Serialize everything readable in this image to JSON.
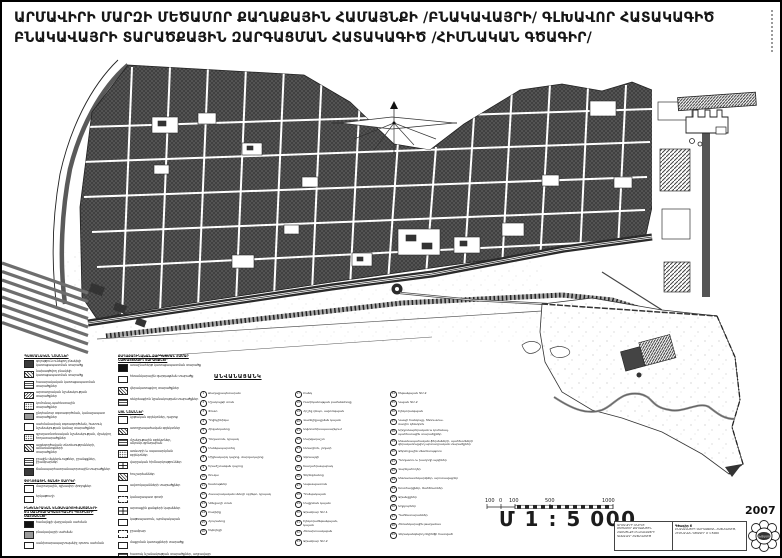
{
  "title": {
    "line1": "ԱՐՄԱՎԻՐԻ ՄԱՐԶԻ ՄԵԾԱՄՈՐ ՔԱՂԱՔԱՅԻՆ ՀԱՄԱՅՆՔԻ /ԲՆԱԿԱՎԱՅՐԻ/ ԳԼԽԱՎՈՐ ՀԱՏԱԿԱԳԻԾ",
    "line2": "ԲՆԱԿԱՎԱՅՐԻ ՏԱՐԱԾՔԱՅԻՆ ԶԱՐԳԱՑՄԱՆ ՀԱՏԱԿԱԳԻԾ /ՀԻՄՆԱԿԱՆ ԳԾԱԳԻՐ/"
  },
  "legend": {
    "columns": [
      [
        {
          "h": "ՊԱՅՄԱՆԱԿԱՆ ՆՇԱՆՆԵՐ"
        },
        {
          "s": "solid",
          "t": "գոյություն ունեցող բնակելի\nկառուցապատման տարածք"
        },
        {
          "s": "hatch",
          "t": "նախագծվող բնակելի\nկառուցապատման տարածք"
        },
        {
          "s": "grid",
          "t": "հասարակական կառուցապատման\nտարածքներ"
        },
        {
          "s": "diag",
          "t": "արտադրական նշանակության\nտարածքներ"
        },
        {
          "s": "dots",
          "t": "կոմունալ-պահեստային\nտարածքներ"
        },
        {
          "s": "gray",
          "t": "ընդհանուր օգտագործման, կանաչապատ\nտարածքներ"
        },
        {
          "s": "outline",
          "t": "սահմանափակ օգտագործման, հատուկ\nնշանակության կանաչ տարածքներ"
        },
        {
          "s": "dots",
          "t": "գյուղատնտեսական նշանակության, մշակվող\nհողատարածքներ"
        },
        {
          "s": "hatch",
          "t": "այգեգործական տնտեսությունների, ամառանոցների\nտարածքներ"
        },
        {
          "s": "grid",
          "t": "ջրային մակերևույթներ, ջրանցքներ,\nջրամբարներ"
        },
        {
          "s": "solid",
          "t": "ճանապարհատրանսպորտային տարածքներ"
        },
        {
          "h": "ՓՈՂՈՑԱՅԻՆ ՑԱՆՑԻ ՏԱՐՐԵՐ"
        },
        {
          "s": "outline",
          "t": "մայրուղային, գլխավոր փողոցներ"
        },
        {
          "s": "outline",
          "t": "երկաթուղի"
        },
        {
          "h": "ԻՆԺԵՆԵՐԱԿԱՆ ԵՆԹԱԿԱՌՈՒՑՎԱԾՔՆԵՐԻ\nԵՎ ՍԱՆԻՏԱՐԱՊԱՇՏՊԱՆԻՉ ԳՈՏԻՆԵՐԻ\nՍԱՀՄԱՆՆԵՐ"
        },
        {
          "s": "dark",
          "t": "համայնքի վարչական սահման"
        },
        {
          "s": "gray",
          "t": "բնակավայրի սահման"
        },
        {
          "s": "outline",
          "t": "սանիտարապաշտպանիչ գոտու սահման"
        }
      ],
      [
        {
          "h": "ՔԱՂԱՔԱՇԻՆԱԿԱՆ ԶԱՐԳԱՑՄԱՆ ՀԱՄԱՐ\nՆԱԽԱՏԵՍՎՈՂ ՏԱՐԱԾՔՆԵՐ"
        },
        {
          "s": "dark",
          "t": "առաջնահերթ կառուցապատման տարածք"
        },
        {
          "s": "outline",
          "t": "հեռանկարային զարգացման տարածք"
        },
        {
          "s": "hatch",
          "t": "վերակառուցվող տարածքներ"
        },
        {
          "s": "grid",
          "t": "ռեկրեացիոն նշանակության տարածքներ"
        },
        {
          "h": "ԱՅԼ ՆՇԱՆՆԵՐ"
        },
        {
          "s": "outline",
          "t": "կրթական օբյեկտներ, դպրոց"
        },
        {
          "s": "hatch",
          "t": "առողջապահական օբյեկտներ"
        },
        {
          "s": "grid",
          "t": "մշակութային օբյեկտներ,\nակումբ-գրադարան"
        },
        {
          "s": "dots",
          "t": "առևտրի և սպասարկման\nօբյեկտներ"
        },
        {
          "s": "cross",
          "t": "վարչական հիմնարկություններ"
        },
        {
          "s": "hatch",
          "t": "հուշարձաններ"
        },
        {
          "s": "outline",
          "t": "ավտոկայանների տարածքներ"
        },
        {
          "s": "dash",
          "t": "կանաչապատ գոտի"
        },
        {
          "s": "cross",
          "t": "արտաքին ցանցերի կայաններ"
        },
        {
          "s": "outline",
          "t": "կաթսայատուն, պոմպակայան"
        },
        {
          "s": "dash",
          "t": "ջրամբար"
        },
        {
          "s": "outline",
          "t": "մաքրման կառույցների տարածք"
        },
        {
          "s": "grid",
          "t": "հատուկ նշանակության տարածքներ, աղբավայր"
        },
        {
          "s": "dash",
          "t": "ապագա թաղամաս"
        }
      ]
    ]
  },
  "index": {
    "header": "ԱՆՎԱՆԱՑԱՆԿ",
    "columns": [
      [
        {
          "n": "1",
          "t": "Քաղաքապետարան"
        },
        {
          "n": "2",
          "t": "Մշակույթի տուն"
        },
        {
          "n": "3",
          "t": "Փոստ"
        },
        {
          "n": "4",
          "t": "Պոլիկլինիկա"
        },
        {
          "n": "5",
          "t": "Հիվանդանոց"
        },
        {
          "n": "6",
          "t": "Դեղատուն, կրպակ"
        },
        {
          "n": "7",
          "t": "Մանկապարտեզ"
        },
        {
          "n": "8",
          "t": "Միջնակարգ դպրոց, մարզադպրոց"
        },
        {
          "n": "9",
          "t": "Երաժշտական դպրոց"
        },
        {
          "n": "10",
          "t": "Շուկա"
        },
        {
          "n": "11",
          "t": "Խանութներ"
        },
        {
          "n": "12",
          "t": "Հասարակական սննդի օբյեկտ, կրպակ"
        },
        {
          "n": "13",
          "t": "Կենցաղի տուն"
        },
        {
          "n": "14",
          "t": "Բաղնիք"
        },
        {
          "n": "15",
          "t": "Հյուրանոց"
        },
        {
          "n": "16",
          "t": "Եկեղեցի"
        }
      ],
      [
        {
          "n": "17",
          "t": "Բանկ"
        },
        {
          "n": "18",
          "t": "Ոստիկանության բաժանմունք"
        },
        {
          "n": "19",
          "t": "Հրշեջ դեպո, ավտոկայան"
        },
        {
          "n": "20",
          "t": "Վառելիքալցման կայան"
        },
        {
          "n": "21",
          "t": "Ավտոտեխսպասարկում"
        },
        {
          "n": "22",
          "t": "Մարզադաշտ"
        },
        {
          "n": "23",
          "t": "Ստադիոն, լողափ"
        },
        {
          "n": "24",
          "t": "Զբոսայգի"
        },
        {
          "n": "25",
          "t": "Խաղահրապարակ"
        },
        {
          "n": "26",
          "t": "Գերեզմանոց"
        },
        {
          "n": "27",
          "t": "Կաթսայատուն"
        },
        {
          "n": "28",
          "t": "Պոմպակայան"
        },
        {
          "n": "29",
          "t": "Մաքրման կայան"
        },
        {
          "n": "30",
          "t": "Ջրամբար ԳՄ-1"
        },
        {
          "n": "31",
          "t": "Էլեկտրաենթակայան,\nկայան"
        },
        {
          "n": "32",
          "t": "Հեռախոսակայան"
        },
        {
          "n": "33",
          "t": "Ջրամբար ԳՄ-2"
        }
      ],
      [
        {
          "n": "34",
          "t": "Ենթակայան ԳՄ-2"
        },
        {
          "n": "35",
          "t": "Կայան ԳՄ-2"
        },
        {
          "n": "36",
          "t": "Էլեկտրակայան"
        },
        {
          "n": "37",
          "t": "Կապի հանգույց, հեռուստա-\nռադիո կենտրոն"
        },
        {
          "n": "38",
          "t": "Արդյունաբերական և կոմունալ-\nպահեստային տարածքներ"
        },
        {
          "n": "39",
          "t": "Անասնապահական ֆերմաների, պահեստների\nվերակառուցվող արտադրական տարածքներ"
        },
        {
          "n": "40",
          "t": "Ջերմոցային տնտեսություն"
        },
        {
          "n": "41",
          "t": "Պտղատու և խաղողի այգիներ"
        },
        {
          "n": "42",
          "t": "Վարելահողեր"
        },
        {
          "n": "43",
          "t": "Անտառատնկարկներ, արոտավայրեր"
        },
        {
          "n": "44",
          "t": "Խոտհարքներ, ճահճուտներ"
        },
        {
          "n": "45",
          "t": "Ջրանցքներ"
        },
        {
          "n": "46",
          "t": "Աղբյուրներ"
        },
        {
          "n": "47",
          "t": "Պահեստարաններ"
        },
        {
          "n": "48",
          "t": "Հեռանկարային թաղամաս"
        },
        {
          "n": "49",
          "t": "Վերականգնվող ռելիեֆի հատված"
        }
      ]
    ]
  },
  "scale": {
    "labels": [
      "100",
      "0",
      "100",
      "500",
      "1000"
    ],
    "text": "Մ 1 : 5 000"
  },
  "titleblock": {
    "left_lines": [
      "ԱՐՄԱՎԻՐԻ ՄԱՐԶԻ",
      "ՄԵԾԱՄՈՐ ՔԱՂԱՔԱՅԻՆ",
      "ՀԱՄԱՅՆՔԻ ԲՆԱԿԱՎԱՅՐԻ",
      "ԳԼԽԱՎՈՐ ՀԱՏԱԿԱԳԻԾ"
    ],
    "right_title": "Գծագիր 6",
    "right_lines": [
      "ԲՆԱԿԱՎԱՅՐԻ ԶԱՐԳԱՑՄԱՆ ՀԱՏԱԿԱԳԻԾ,",
      "ՀԻՄՆԱԿԱՆ ԳԾԱԳԻՐ Մ 1:5000"
    ],
    "stamp_text": "ՄԵԾԱՄՈՐ",
    "year": "2007"
  }
}
